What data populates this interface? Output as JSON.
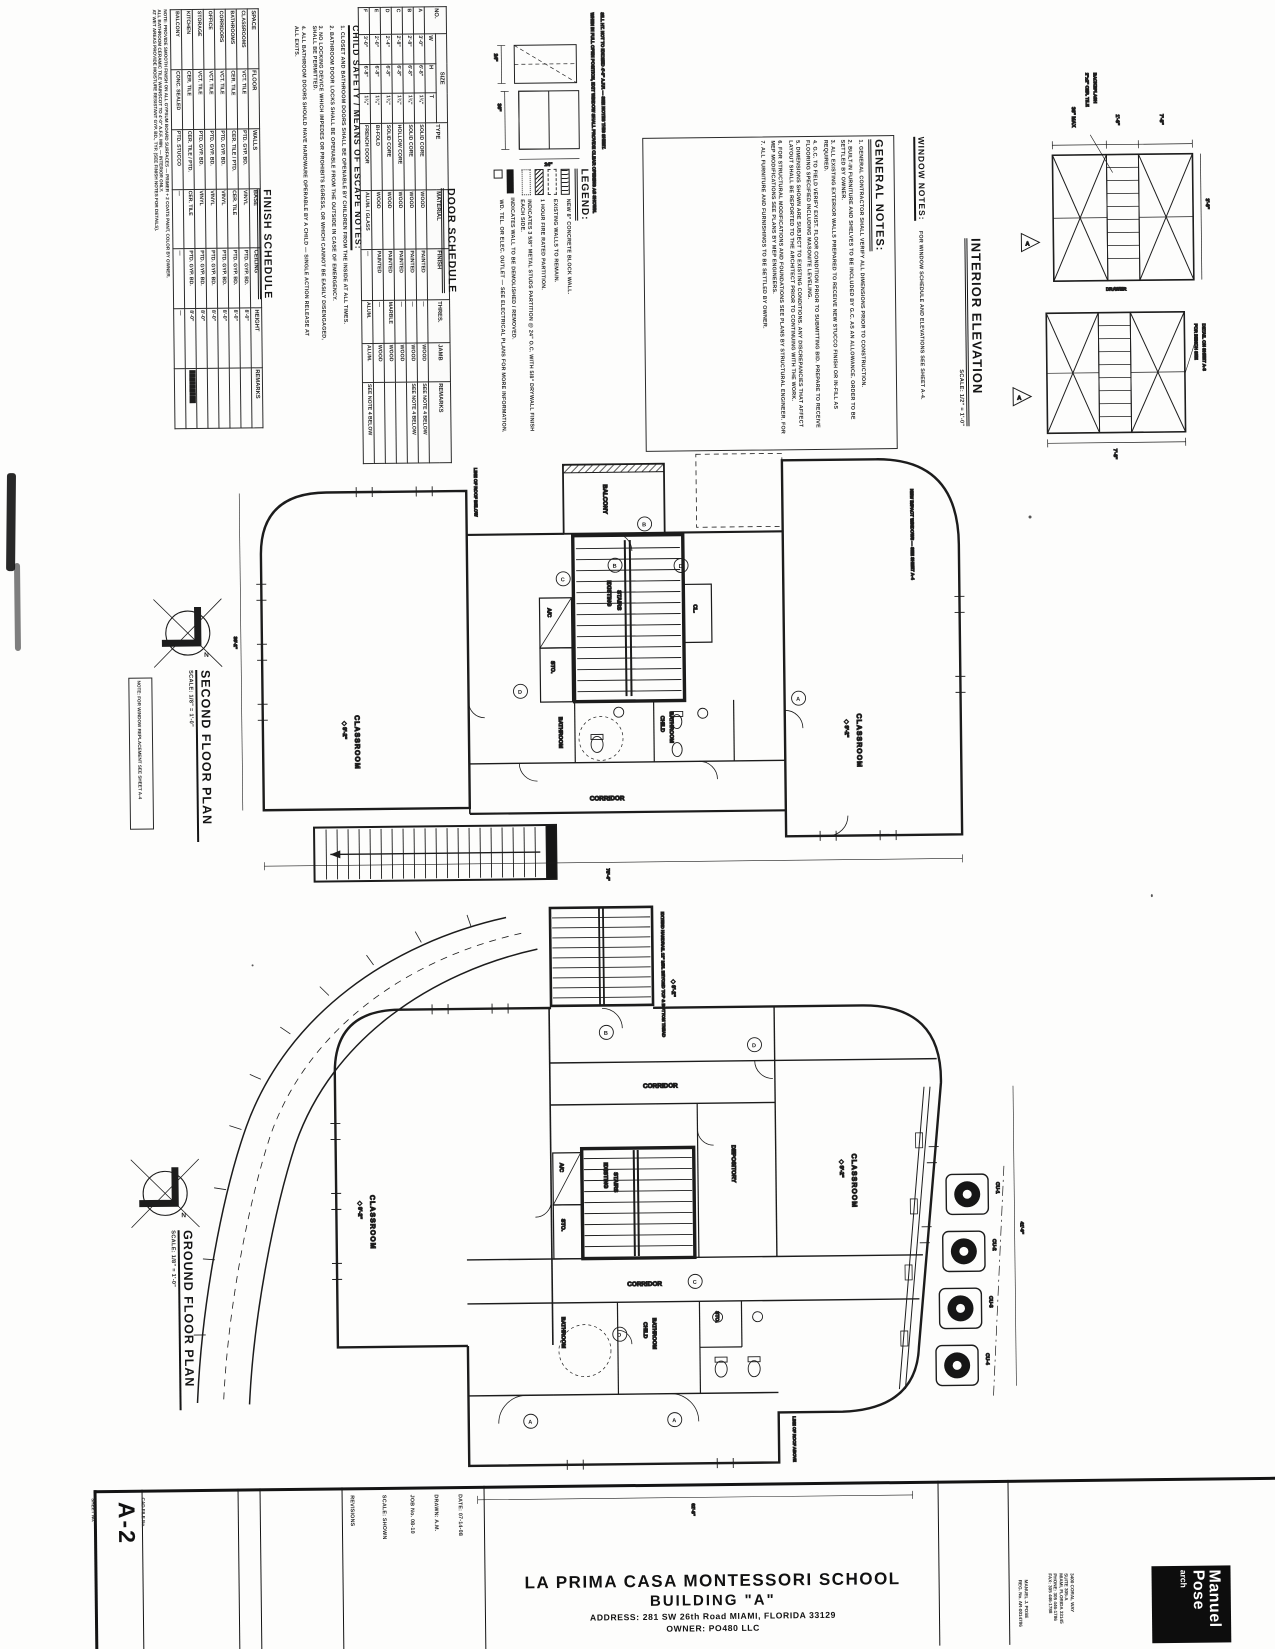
{
  "sheet": {
    "number": "A-2",
    "sheet_label": "SHEET No.",
    "cad_label": "CAD FILE No.",
    "project_title": "LA PRIMA CASA MONTESSORI SCHOOL",
    "building": "BUILDING \"A\"",
    "address": "ADDRESS: 281 SW 26th Road MIAMI, FLORIDA 33129",
    "owner": "OWNER: PO480 LLC"
  },
  "titleblock": {
    "fields": [
      "DATE: 07-14-08",
      "DRAWN: A.M.",
      "JOB No. 08-10",
      "SCALE: SHOWN",
      "REVISIONS"
    ],
    "firm": {
      "name1": "Manuel",
      "name2": "Pose",
      "name3": "arch",
      "contact": [
        "3400 CORAL WAY",
        "SUITE 305-A",
        "MIAMI, FLORIDA 33145",
        "PHONE: 305 446-1786",
        "FAX: 305 446-1788"
      ],
      "license": "MANUEL J. POSE",
      "license2": "REG. No. AR-0014786"
    }
  },
  "finish_schedule": {
    "title": "FINISH SCHEDULE",
    "columns": [
      "SPACE",
      "FLOOR",
      "WALLS",
      "BASE",
      "CEILING",
      "HEIGHT",
      "REMARKS"
    ],
    "rows": [
      [
        "CLASSROOMS",
        "VCT. TILE",
        "PTD. GYP. BD.",
        "VINYL",
        "PTD. GYP. BD.",
        "8'-0\"",
        ""
      ],
      [
        "BATHROOMS",
        "CER. TILE",
        "CER. TILE / PTD.",
        "CER. TILE",
        "PTD. GYP. BD.",
        "8'-0\"",
        ""
      ],
      [
        "CORRIDORS",
        "VCT. TILE",
        "PTD. GYP. BD.",
        "VINYL",
        "PTD. GYP. BD.",
        "8'-0\"",
        ""
      ],
      [
        "OFFICE",
        "VCT. TILE",
        "PTD. GYP. BD.",
        "VINYL",
        "PTD. GYP. BD.",
        "8'-0\"",
        ""
      ],
      [
        "STORAGE",
        "VCT. TILE",
        "PTD. GYP. BD.",
        "VINYL",
        "PTD. GYP. BD.",
        "8'-0\"",
        ""
      ],
      [
        "KITCHEN",
        "CER. TILE",
        "CER. TILE / PTD.",
        "CER. TILE",
        "PTD. GYP. BD.",
        "8'-0\"",
        "█████████"
      ],
      [
        "BALCONY",
        "CONC. SEALED",
        "PTD. STUCCO",
        "—",
        "—",
        "—",
        ""
      ]
    ],
    "notes": [
      "NOTE: PROVIDE SMOOTH FINISH ON ALL GYPSUM BOARD SURFACES — PRIMER + 2 COATS PAINT, COLOR BY OWNER.",
      "ALL BATHROOM CERAMIC TILE WAINSCOT TO 4'-0\" A.F.F. MIN. — INTERIOR ONLY.",
      "AT WET AREAS PROVIDE MOISTURE RESISTANT GYP. BD., TYP. (SEE FINISH NOTES FOR DETAILS)."
    ]
  },
  "door_schedule": {
    "title": "DOOR SCHEDULE",
    "headers": {
      "no": "NO.",
      "size": "SIZE",
      "w": "W",
      "h": "H",
      "t": "T",
      "type": "TYPE",
      "material": "MATERIAL",
      "finish": "FINISH",
      "thres": "THRES.",
      "jamb": "JAMB",
      "remarks": "REMARKS"
    },
    "rows": [
      [
        "A",
        "3'-0\"",
        "6'-8\"",
        "1¾\"",
        "SOLID CORE",
        "WOOD",
        "PAINTED",
        "—",
        "WOOD",
        "SEE NOTE 4 BELOW"
      ],
      [
        "B",
        "2'-8\"",
        "6'-8\"",
        "1¾\"",
        "SOLID CORE",
        "WOOD",
        "PAINTED",
        "—",
        "WOOD",
        "SEE NOTE 4 BELOW"
      ],
      [
        "C",
        "2'-8\"",
        "6'-8\"",
        "1¾\"",
        "HOLLOW CORE",
        "WOOD",
        "PAINTED",
        "—",
        "WOOD",
        ""
      ],
      [
        "D",
        "2'-4\"",
        "6'-8\"",
        "1¾\"",
        "SOLID CORE",
        "WOOD",
        "PAINTED",
        "MARBLE",
        "WOOD",
        ""
      ],
      [
        "E",
        "2'-0\"",
        "6'-8\"",
        "1¾\"",
        "BI-FOLD",
        "WOOD",
        "PAINTED",
        "—",
        "WOOD",
        ""
      ],
      [
        "F",
        "3'-0\"",
        "6'-8\"",
        "1¾\"",
        "FRENCH DOOR",
        "ALUM. / GLASS",
        "—",
        "ALUM.",
        "ALUM.",
        "SEE NOTE 4 BELOW"
      ]
    ]
  },
  "child_safety": {
    "title": "CHILD SAFETY / MEANS OF ESCAPE NOTES:",
    "items": [
      "1. CLOSET AND BATHROOM DOORS SHALL BE OPENABLE BY CHILDREN FROM THE INSIDE AT ALL TIMES.",
      "2. BATHROOM DOOR LOCKS SHALL BE OPENABLE FROM THE OUTSIDE IN CASE OF EMERGENCY.",
      "3. NO LOCKING DEVICE WHICH IMPEDES OR PROHIBITS EGRESS, OR WHICH CANNOT BE EASILY DISENGAGED, SHALL BE PERMITTED.",
      "4. ALL BATHROOM DOORS SHOULD HAVE HARDWARE OPERABLE BY A CHILD — SINGLE ACTION RELEASE AT ALL EXITS."
    ],
    "diagram_notes": [
      "WHEN IN FULL OPEN POSITION, EXIT WINDOW SHALL PROVIDE CLEAR OPENING AS SHOWN.",
      "SILL HT. NOT TO EXCEED 4'-6\" A.F.F. — SEE NOTES THIS SHEET."
    ],
    "dims": [
      "24\"",
      "36\"",
      "24\""
    ]
  },
  "legend": {
    "title": "LEGEND:",
    "items": [
      "NEW 8\" CONCRETE BLOCK WALL.",
      "EXISTING WALLS TO REMAIN.",
      "1 HOUR FIRE RATED PARTITION.",
      "INDICATES 3 5/8\" METAL STUDS PARTITION @ 24\" O.C. WITH 5/8\" DRYWALL FINISH EACH SIDE.",
      "INDICATES WALL TO BE DEMOLISHED / REMOVED.",
      "WD. TEL. OR ELEC. OUTLET — SEE ELECTRICAL PLANS FOR MORE INFORMATION."
    ]
  },
  "general_notes": {
    "title": "GENERAL NOTES:",
    "items": [
      "1.  GENERAL CONTRACTOR SHALL VERIFY ALL DIMENSIONS PRIOR TO CONSTRUCTION.",
      "2.  BUILT-IN FURNITURE AND SHELVES TO BE INCLUDED BY G.C. AS AN ALLOWANCE. ORDER TO BE SETTLED BY OWNER.",
      "3.  ALL EXISTING EXTERIOR WALLS PREPARED TO RECEIVE NEW STUCCO FINISH OR IN-FILL AS REQUIRED.",
      "4.  G.C. TO FIELD VERIFY EXIST. FLOOR CONDITION PRIOR TO SUBMITTING BID. PREPARE TO RECEIVE FLOORING SPECIFIED INCLUDING MASONITE LEVELING.",
      "5.  DIMENSIONS SHOWN ARE SUBJECT TO EXISTING CONDITIONS. ANY DISCREPANCIES THAT AFFECT LAYOUT SHALL BE REPORTED TO THE ARCHITECT PRIOR TO CONTINUING WITH THE WORK.",
      "6.  FOR STRUCTURAL MODIFICATIONS AND FOUNDATIONS SEE PLANS BY STRUCTURAL ENGINEER. FOR MEP MODIFICATIONS SEE PLANS BY MEP ENGINEERS.",
      "7.  ALL FURNITURE AND FURNISHINGS TO BE SETTLED BY OWNER."
    ]
  },
  "window_notes": {
    "title": "WINDOW NOTES:",
    "body": "FOR WINDOW SCHEDULE AND ELEVATIONS SEE SHEET A-4."
  },
  "interior_elevation": {
    "title": "INTERIOR ELEVATION",
    "scale": "SCALE: 1/2\" = 1'-0\"",
    "marker": "A",
    "dim_top1": "36\" MAX",
    "dim_top2": "1'-6\"",
    "dim_top3": "7'-8\"",
    "dim_bottom": "7'-8\"",
    "dim_side": "3'-0\"",
    "drawer": "DRAWER",
    "backsplash1": "2\"x2\" CER. TILE",
    "backsplash2": "BACKSPLASH",
    "bench1": "FOR BENCH SEE",
    "bench2": "DETAIL ON SHEET A-3"
  },
  "plans": {
    "north": "N",
    "second": {
      "title": "SECOND FLOOR PLAN",
      "scale": "SCALE: 1/8\" = 1'-0\"",
      "note": "NOTE: FOR WINDOW REPLACEMENT SEE SHEET A-4",
      "labels": {
        "balcony": "BALCONY",
        "stairs1": "EXISTING",
        "stairs2": "STAIRS",
        "ac": "A/C",
        "sto": "STO.",
        "cl": "CL.",
        "bathroom": "BATHROOM",
        "child1": "CHILD",
        "child2": "BATHROOM",
        "corridor": "CORRIDOR",
        "classroom_l": "CLASSROOM",
        "classroom_r": "CLASSROOM",
        "elev_l": "◆ 9'-2\"",
        "elev_r": "◆ 9'-2\""
      },
      "tags": [
        "B",
        "C",
        "D",
        "B",
        "D",
        "A"
      ],
      "anno1": "NEW IMPACT WINDOWS — SEE SHEET A-4",
      "anno2": "LINE OF ROOF BELOW",
      "dim_bottom": "78'-4\"",
      "dim_left": "36'-2\""
    },
    "ground": {
      "title": "GROUND FLOOR PLAN",
      "scale": "SCALE: 1/8\" = 1'-0\"",
      "labels": {
        "stairs1": "EXISTING",
        "stairs2": "STAIRS",
        "ac": "A/C",
        "sto": "STO.",
        "sto2": "STO.",
        "corridor_top": "CORRIDOR",
        "corridor_bottom": "CORRIDOR",
        "depository": "DEPOSITORY",
        "child1": "CHILD",
        "child2": "BATHROOM",
        "bathroom": "BATHROOM",
        "classroom_l": "CLASSROOM",
        "classroom_r": "CLASSROOM",
        "elev_l": "◆ 9'-2\"",
        "elev_r": "◆ 9'-2\"",
        "elev_stair": "◆ 9'-2\"",
        "cu": [
          "CU-1",
          "CU-2",
          "CU-3",
          "CU-4"
        ]
      },
      "tags": [
        "B",
        "D",
        "C",
        "D",
        "A",
        "A"
      ],
      "anno1": "EXTEND HANDRAIL 12\" MIN. BEYOND TOP & BOTTOM TREAD",
      "anno2": "LINE OF ROOF ABOVE",
      "dim_bottom": "62'-8\"",
      "dim_right": "41'-0\""
    }
  }
}
